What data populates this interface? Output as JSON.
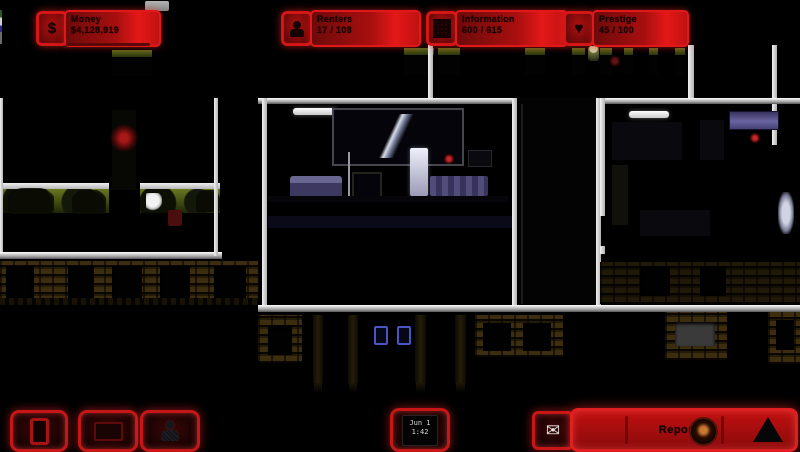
{
  "stats": {
    "money": {
      "label": "Money",
      "value": "$4,128,919"
    },
    "renters": {
      "label": "Renters",
      "value": "17 / 108"
    },
    "information": {
      "label": "Information",
      "value": "600 / 615"
    },
    "prestige": {
      "label": "Prestige",
      "value": "45 / 100"
    }
  },
  "icons": {
    "money_glyph": "$",
    "prestige_glyph": "♥",
    "mail_glyph": "✉"
  },
  "clock": {
    "line1": "Jun 1",
    "line2": "1:42"
  },
  "report": {
    "label": "Report"
  },
  "colors": {
    "accent_red": "#d41616",
    "panel_red": "#8a0e0e",
    "hedge_green": "#55611c",
    "brick_brown": "#3c2d0e",
    "wall_white": "#e0e0e0",
    "window_purple": "#4c4678",
    "glyph_blue": "#4a55c0"
  }
}
